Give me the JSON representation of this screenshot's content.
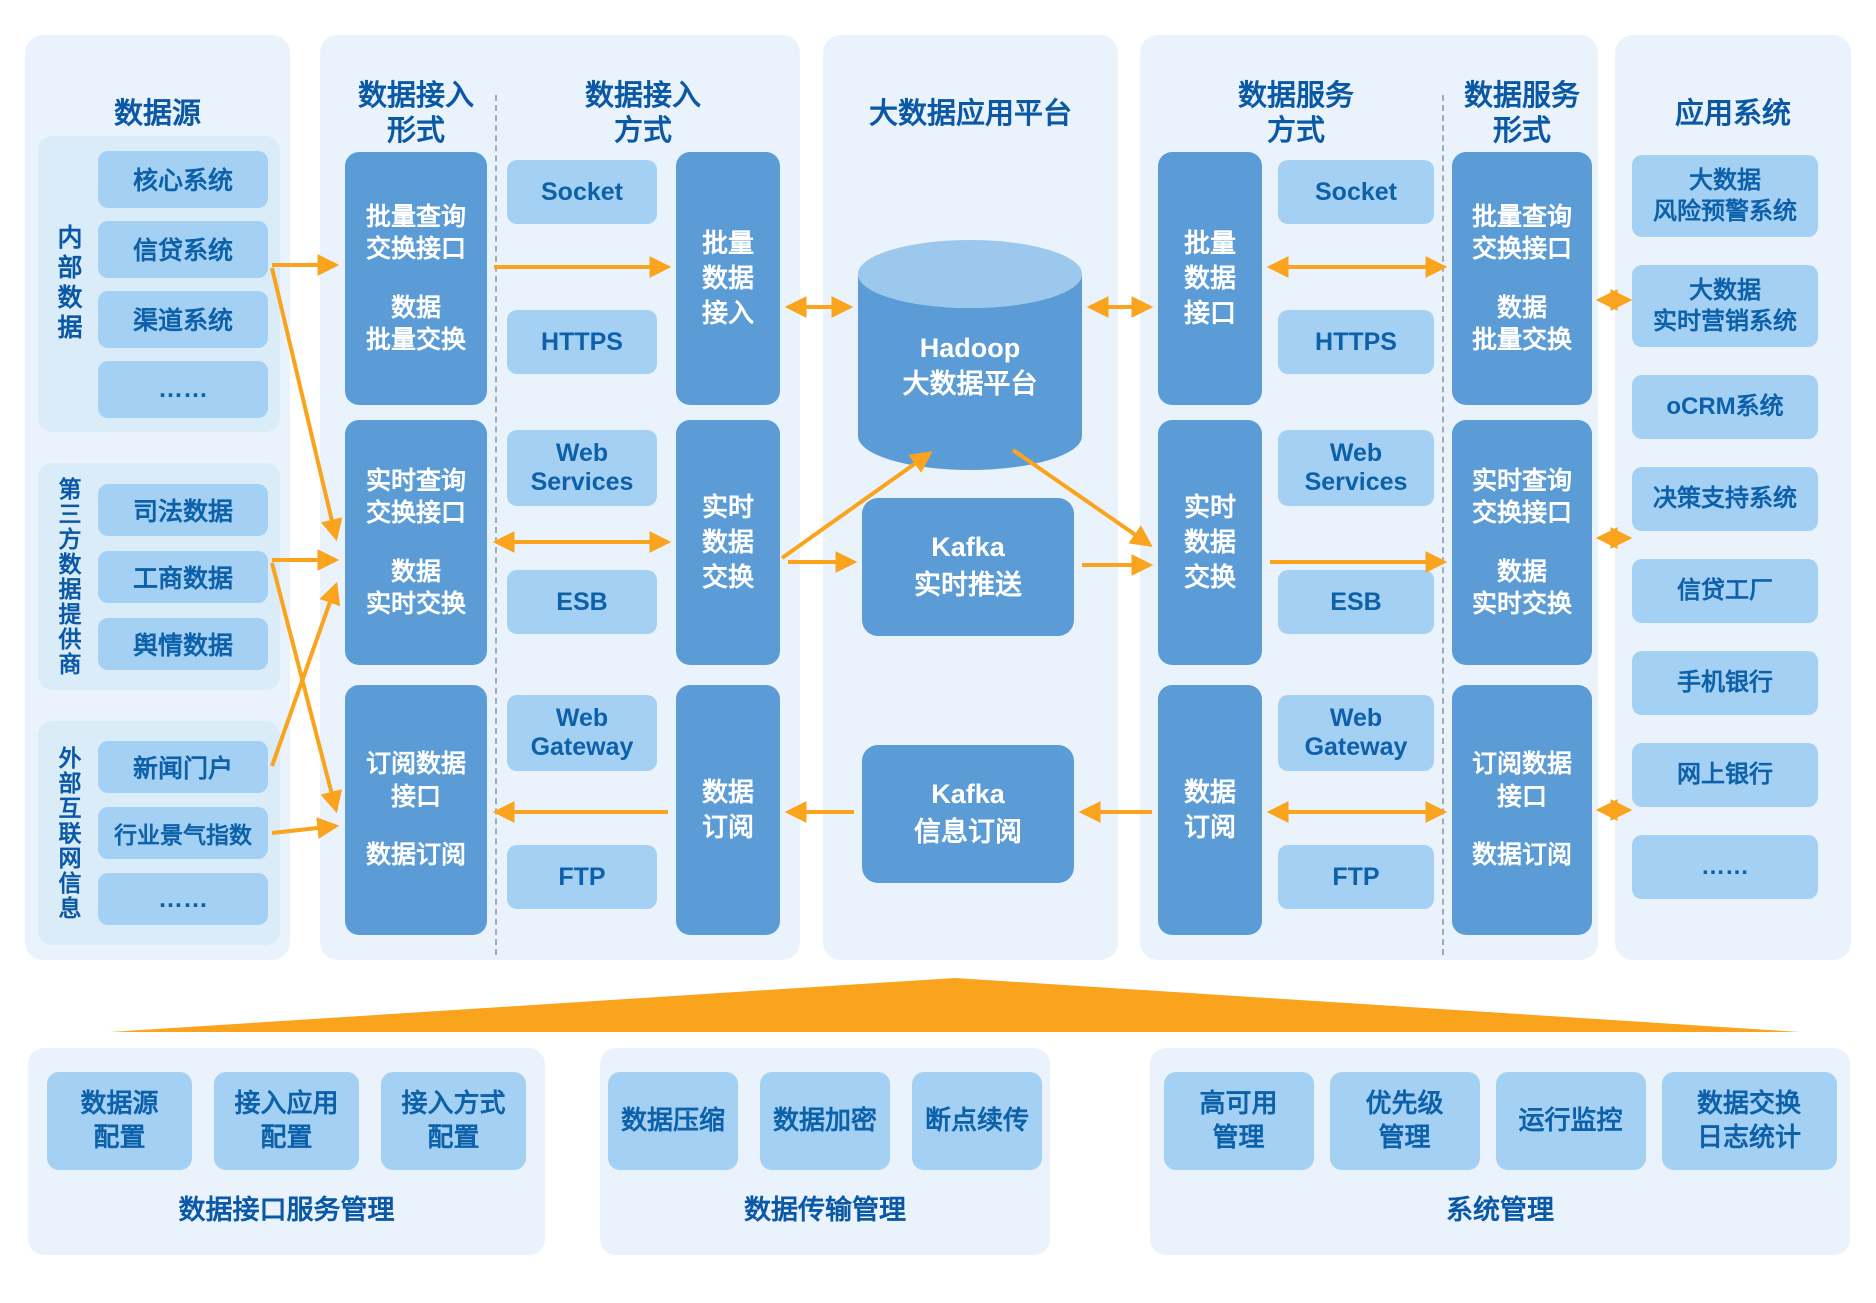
{
  "colors": {
    "panel": "#EAF3FB",
    "panel_inner": "#DBECF9",
    "box": "#A4D1F3",
    "block": "#5C9CD6",
    "cylinder_top": "#9CC8EE",
    "heading": "#0A58A6",
    "label": "#0D60AA",
    "orange": "#F9A41C",
    "divider": "#9DAEBB",
    "white": "#FFFFFF"
  },
  "sources": {
    "title": "数据源",
    "groups": [
      {
        "label": "内部数据",
        "items": [
          "核心系统",
          "信贷系统",
          "渠道系统",
          "……"
        ]
      },
      {
        "label": "第三方数据提供商",
        "items": [
          "司法数据",
          "工商数据",
          "舆情数据"
        ]
      },
      {
        "label": "外部互联网信息",
        "items": [
          "新闻门户",
          "行业景气指数",
          "……"
        ]
      }
    ]
  },
  "ingest": {
    "form_title": [
      "数据接入",
      "形式"
    ],
    "mode_title": [
      "数据接入",
      "方式"
    ],
    "blocks": [
      {
        "top": [
          "批量查询",
          "交换接口"
        ],
        "bottom": [
          "数据",
          "批量交换"
        ]
      },
      {
        "top": [
          "实时查询",
          "交换接口"
        ],
        "bottom": [
          "数据",
          "实时交换"
        ]
      },
      {
        "top": [
          "订阅数据",
          "接口"
        ],
        "bottom": [
          "数据订阅"
        ]
      }
    ],
    "protocols": [
      "Socket",
      "HTTPS",
      "Web Services",
      "ESB",
      "Web Gateway",
      "FTP"
    ],
    "bars": [
      [
        "批量",
        "数据",
        "接入"
      ],
      [
        "实时",
        "数据",
        "交换"
      ],
      [
        "数据",
        "订阅"
      ]
    ]
  },
  "platform": {
    "title": "大数据应用平台",
    "hadoop": [
      "Hadoop",
      "大数据平台"
    ],
    "kafka_push": [
      "Kafka",
      "实时推送"
    ],
    "kafka_sub": [
      "Kafka",
      "信息订阅"
    ]
  },
  "service": {
    "mode_title": [
      "数据服务",
      "方式"
    ],
    "form_title": [
      "数据服务",
      "形式"
    ],
    "bars": [
      [
        "批量",
        "数据",
        "接口"
      ],
      [
        "实时",
        "数据",
        "交换"
      ],
      [
        "数据",
        "订阅"
      ]
    ],
    "protocols": [
      "Socket",
      "HTTPS",
      "Web Services",
      "ESB",
      "Web Gateway",
      "FTP"
    ],
    "blocks": [
      {
        "top": [
          "批量查询",
          "交换接口"
        ],
        "bottom": [
          "数据",
          "批量交换"
        ]
      },
      {
        "top": [
          "实时查询",
          "交换接口"
        ],
        "bottom": [
          "数据",
          "实时交换"
        ]
      },
      {
        "top": [
          "订阅数据",
          "接口"
        ],
        "bottom": [
          "数据订阅"
        ]
      }
    ]
  },
  "apps": {
    "title": "应用系统",
    "items": [
      [
        "大数据",
        "风险预警系统"
      ],
      [
        "大数据",
        "实时营销系统"
      ],
      [
        "oCRM系统"
      ],
      [
        "决策支持系统"
      ],
      [
        "信贷工厂"
      ],
      [
        "手机银行"
      ],
      [
        "网上银行"
      ],
      [
        "……"
      ]
    ]
  },
  "management": {
    "panels": [
      {
        "caption": "数据接口服务管理",
        "boxes": [
          [
            "数据源",
            "配置"
          ],
          [
            "接入应用",
            "配置"
          ],
          [
            "接入方式",
            "配置"
          ]
        ]
      },
      {
        "caption": "数据传输管理",
        "boxes": [
          [
            "数据压缩"
          ],
          [
            "数据加密"
          ],
          [
            "断点续传"
          ]
        ]
      },
      {
        "caption": "系统管理",
        "boxes": [
          [
            "高可用",
            "管理"
          ],
          [
            "优先级",
            "管理"
          ],
          [
            "运行监控"
          ],
          [
            "数据交换",
            "日志统计"
          ]
        ]
      }
    ]
  }
}
